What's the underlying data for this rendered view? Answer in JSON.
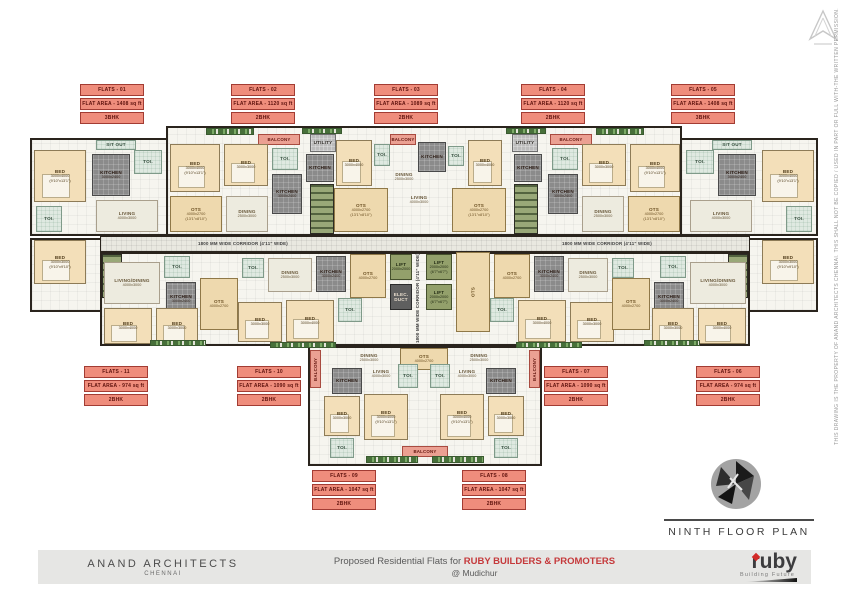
{
  "title_block": {
    "plan_title": "NINTH FLOOR PLAN",
    "firm_name": "ANAND ARCHITECTS",
    "firm_city": "CHENNAI",
    "project_text": "Proposed Residential Flats for",
    "client_name": "RUBY BUILDERS & PROMOTERS",
    "location_text": "@ Mudichur",
    "brand_name": "ruby",
    "brand_tagline": "Building Future"
  },
  "disclaimer": "THIS DRAWING IS THE PROPERTY OF ANAND ARCHITECTS CHENNAI. THIS SHALL NOT BE COPIED / USED IN PART OR FULL WITH-THE WRITTEN PERMISSION.",
  "colors": {
    "accent_red": "#c5393b",
    "flat_label_bg": "#ef8d7c",
    "flat_label_border": "#a23c33",
    "room_cream": "#f3dfb9",
    "ots_beige": "#eed9ae",
    "lift_green": "#93a06b",
    "kitchen_grey": "#8b8b8b"
  },
  "flat_labels": [
    {
      "name": "FLATS - 01",
      "area": "FLAT AREA - 1408 sq ft",
      "bhk": "3BHK",
      "x": 80,
      "y": 84
    },
    {
      "name": "FLATS - 02",
      "area": "FLAT AREA - 1120 sq ft",
      "bhk": "2BHK",
      "x": 231,
      "y": 84
    },
    {
      "name": "FLATS - 03",
      "area": "FLAT AREA - 1089 sq ft",
      "bhk": "2BHK",
      "x": 374,
      "y": 84
    },
    {
      "name": "FLATS - 04",
      "area": "FLAT AREA - 1120 sq ft",
      "bhk": "2BHK",
      "x": 521,
      "y": 84
    },
    {
      "name": "FLATS - 05",
      "area": "FLAT AREA - 1408 sq ft",
      "bhk": "3BHK",
      "x": 671,
      "y": 84
    },
    {
      "name": "FLATS - 11",
      "area": "FLAT AREA - 974 sq ft",
      "bhk": "2BHK",
      "x": 84,
      "y": 366
    },
    {
      "name": "FLATS - 10",
      "area": "FLAT AREA - 1090 sq ft",
      "bhk": "2BHK",
      "x": 237,
      "y": 366
    },
    {
      "name": "FLATS - 07",
      "area": "FLAT AREA - 1090 sq ft",
      "bhk": "2BHK",
      "x": 544,
      "y": 366
    },
    {
      "name": "FLATS - 06",
      "area": "FLAT AREA - 974 sq ft",
      "bhk": "2BHK",
      "x": 696,
      "y": 366
    },
    {
      "name": "FLATS - 09",
      "area": "FLAT AREA - 1047 sq ft",
      "bhk": "2BHK",
      "x": 312,
      "y": 470
    },
    {
      "name": "FLATS - 08",
      "area": "FLAT AREA - 1047 sq ft",
      "bhk": "2BHK",
      "x": 462,
      "y": 470
    }
  ],
  "plan": {
    "blocks": [
      {
        "x": 30,
        "y": 138,
        "w": 140,
        "h": 98
      },
      {
        "x": 166,
        "y": 126,
        "w": 516,
        "h": 110
      },
      {
        "x": 680,
        "y": 138,
        "w": 138,
        "h": 98
      },
      {
        "x": 30,
        "y": 238,
        "w": 72,
        "h": 74
      },
      {
        "x": 746,
        "y": 238,
        "w": 72,
        "h": 74
      },
      {
        "x": 100,
        "y": 252,
        "w": 650,
        "h": 94
      },
      {
        "x": 308,
        "y": 346,
        "w": 234,
        "h": 120
      },
      {
        "cls": "corridorblk",
        "x": 100,
        "y": 236,
        "w": 650,
        "h": 16
      }
    ],
    "rooms": [
      {
        "cls": "toi",
        "label": "SIT OUT",
        "x": 96,
        "y": 140,
        "w": 40,
        "h": 10
      },
      {
        "cls": "bed",
        "label": "BED",
        "dim": "3000x4000",
        "dim2": "(9'10\"x13'1\")",
        "x": 34,
        "y": 150,
        "w": 52,
        "h": 52
      },
      {
        "cls": "kitchen",
        "label": "KITCHEN",
        "dim": "3000x2400",
        "x": 92,
        "y": 154,
        "w": 38,
        "h": 42
      },
      {
        "cls": "toi",
        "label": "TOI.",
        "x": 134,
        "y": 150,
        "w": 28,
        "h": 24
      },
      {
        "cls": "hall",
        "label": "LIVING",
        "dim": "4000x3000",
        "x": 96,
        "y": 200,
        "w": 62,
        "h": 32
      },
      {
        "cls": "toi",
        "label": "TOI.",
        "x": 36,
        "y": 206,
        "w": 26,
        "h": 26
      },
      {
        "cls": "bed",
        "label": "BED",
        "dim": "3000x3000",
        "dim2": "(9'10\"x9'10\")",
        "x": 34,
        "y": 240,
        "w": 52,
        "h": 44
      },
      {
        "cls": "plants",
        "x": 206,
        "y": 128,
        "w": 48,
        "h": 7
      },
      {
        "cls": "balcony-label",
        "label": "BALCONY",
        "x": 258,
        "y": 134,
        "w": 42,
        "h": 11
      },
      {
        "cls": "bed",
        "label": "BED",
        "dim": "3000x4000",
        "dim2": "(9'10\"x13'1\")",
        "x": 170,
        "y": 144,
        "w": 50,
        "h": 48
      },
      {
        "cls": "bed",
        "label": "BED",
        "dim": "3000x3000",
        "x": 224,
        "y": 144,
        "w": 44,
        "h": 42
      },
      {
        "cls": "toi",
        "label": "TOI.",
        "x": 272,
        "y": 148,
        "w": 26,
        "h": 22
      },
      {
        "cls": "kitchen",
        "label": "KITCHEN",
        "dim": "3000x2400",
        "x": 272,
        "y": 174,
        "w": 30,
        "h": 40
      },
      {
        "cls": "ots",
        "label": "OTS",
        "dim": "4000x2700",
        "dim2": "(13'1\"x8'10\")",
        "x": 170,
        "y": 196,
        "w": 52,
        "h": 36
      },
      {
        "cls": "hall",
        "label": "DINING",
        "dim": "2500x3000",
        "x": 226,
        "y": 196,
        "w": 42,
        "h": 36
      },
      {
        "cls": "plants",
        "x": 302,
        "y": 128,
        "w": 40,
        "h": 6
      },
      {
        "cls": "plants",
        "x": 506,
        "y": 128,
        "w": 40,
        "h": 6
      },
      {
        "cls": "utility",
        "label": "UTILITY",
        "x": 310,
        "y": 134,
        "w": 26,
        "h": 18
      },
      {
        "cls": "kitchen",
        "label": "KITCHEN",
        "x": 306,
        "y": 154,
        "w": 28,
        "h": 28
      },
      {
        "cls": "stair",
        "x": 310,
        "y": 184,
        "w": 24,
        "h": 50
      },
      {
        "cls": "bed",
        "label": "BED",
        "dim": "3000x4000",
        "x": 336,
        "y": 140,
        "w": 36,
        "h": 46
      },
      {
        "cls": "toi",
        "label": "TOI.",
        "x": 374,
        "y": 144,
        "w": 16,
        "h": 22
      },
      {
        "cls": "balcony-label",
        "label": "BALCONY",
        "x": 390,
        "y": 134,
        "w": 26,
        "h": 11
      },
      {
        "cls": "kitchen",
        "label": "KITCHEN",
        "x": 418,
        "y": 142,
        "w": 28,
        "h": 30
      },
      {
        "cls": "toi",
        "label": "TOI.",
        "x": 448,
        "y": 146,
        "w": 16,
        "h": 20
      },
      {
        "cls": "bed",
        "label": "BED",
        "dim": "3000x4000",
        "x": 468,
        "y": 140,
        "w": 34,
        "h": 46
      },
      {
        "cls": "kitchen",
        "label": "KITCHEN",
        "x": 514,
        "y": 154,
        "w": 28,
        "h": 28
      },
      {
        "cls": "utility",
        "label": "UTILITY",
        "x": 512,
        "y": 134,
        "w": 26,
        "h": 18
      },
      {
        "cls": "stair",
        "x": 514,
        "y": 184,
        "w": 24,
        "h": 50
      },
      {
        "cls": "ots",
        "label": "OTS",
        "dim": "4000x2700",
        "dim2": "(13'1\"x8'10\")",
        "x": 334,
        "y": 188,
        "w": 54,
        "h": 44
      },
      {
        "cls": "ots",
        "label": "OTS",
        "dim": "4000x2700",
        "dim2": "(13'1\"x8'10\")",
        "x": 452,
        "y": 188,
        "w": 54,
        "h": 44
      },
      {
        "cls": "openlabel",
        "label": "DINING",
        "dim": "2500x3000",
        "x": 390,
        "y": 168,
        "w": 28,
        "h": 18
      },
      {
        "cls": "openlabel",
        "label": "LIVING",
        "dim": "4000x3000",
        "x": 404,
        "y": 192,
        "w": 30,
        "h": 16
      },
      {
        "cls": "plants",
        "x": 596,
        "y": 128,
        "w": 48,
        "h": 7
      },
      {
        "cls": "balcony-label",
        "label": "BALCONY",
        "x": 550,
        "y": 134,
        "w": 42,
        "h": 11
      },
      {
        "cls": "bed",
        "label": "BED",
        "dim": "3000x4000",
        "dim2": "(9'10\"x13'1\")",
        "x": 630,
        "y": 144,
        "w": 50,
        "h": 48
      },
      {
        "cls": "bed",
        "label": "BED",
        "dim": "3000x3000",
        "x": 582,
        "y": 144,
        "w": 44,
        "h": 42
      },
      {
        "cls": "toi",
        "label": "TOI.",
        "x": 552,
        "y": 148,
        "w": 26,
        "h": 22
      },
      {
        "cls": "kitchen",
        "label": "KITCHEN",
        "dim": "3000x2400",
        "x": 548,
        "y": 174,
        "w": 30,
        "h": 40
      },
      {
        "cls": "ots",
        "label": "OTS",
        "dim": "4000x2700",
        "dim2": "(13'1\"x8'10\")",
        "x": 628,
        "y": 196,
        "w": 52,
        "h": 36
      },
      {
        "cls": "hall",
        "label": "DINING",
        "dim": "2500x3000",
        "x": 582,
        "y": 196,
        "w": 42,
        "h": 36
      },
      {
        "cls": "toi",
        "label": "SIT OUT",
        "x": 712,
        "y": 140,
        "w": 40,
        "h": 10
      },
      {
        "cls": "bed",
        "label": "BED",
        "dim": "3000x4000",
        "dim2": "(9'10\"x13'1\")",
        "x": 762,
        "y": 150,
        "w": 52,
        "h": 52
      },
      {
        "cls": "kitchen",
        "label": "KITCHEN",
        "dim": "3000x2400",
        "x": 718,
        "y": 154,
        "w": 38,
        "h": 42
      },
      {
        "cls": "toi",
        "label": "TOI.",
        "x": 686,
        "y": 150,
        "w": 28,
        "h": 24
      },
      {
        "cls": "hall",
        "label": "LIVING",
        "dim": "4000x3000",
        "x": 690,
        "y": 200,
        "w": 62,
        "h": 32
      },
      {
        "cls": "toi",
        "label": "TOI.",
        "x": 786,
        "y": 206,
        "w": 26,
        "h": 26
      },
      {
        "cls": "bed",
        "label": "BED",
        "dim": "3000x3000",
        "dim2": "(9'10\"x9'10\")",
        "x": 762,
        "y": 240,
        "w": 52,
        "h": 44
      },
      {
        "cls": "corlabel",
        "label": "1800 MM WIDE CORRIDOR (4'11\" WIDE)",
        "x": 176,
        "y": 238,
        "w": 134,
        "h": 12
      },
      {
        "cls": "corlabel",
        "label": "1800 MM WIDE CORRIDOR (4'11\" WIDE)",
        "x": 540,
        "y": 238,
        "w": 134,
        "h": 12
      },
      {
        "cls": "corlabel vtext",
        "label": "1800 MM WIDE CORRIDOR (4'11\" WIDE)",
        "x": 412,
        "y": 252,
        "w": 11,
        "h": 92
      },
      {
        "cls": "lift",
        "label": "LIFT",
        "dim": "2000x2000",
        "x": 390,
        "y": 254,
        "w": 22,
        "h": 26
      },
      {
        "cls": "duct",
        "label": "ELEC. DUCT",
        "x": 390,
        "y": 284,
        "w": 22,
        "h": 26
      },
      {
        "cls": "lift",
        "label": "LIFT",
        "dim": "2000x2000",
        "dim2": "(6'7\"x6'7\")",
        "x": 426,
        "y": 254,
        "w": 26,
        "h": 26
      },
      {
        "cls": "lift",
        "label": "LIFT",
        "dim": "2000x2000",
        "dim2": "(6'7\"x6'7\")",
        "x": 426,
        "y": 284,
        "w": 26,
        "h": 26
      },
      {
        "cls": "ots vtext",
        "label": "OTS",
        "x": 456,
        "y": 252,
        "w": 34,
        "h": 80
      },
      {
        "cls": "stair",
        "x": 102,
        "y": 254,
        "w": 20,
        "h": 44
      },
      {
        "cls": "stair",
        "x": 728,
        "y": 254,
        "w": 20,
        "h": 44
      },
      {
        "cls": "hall",
        "label": "LIVING/DINING",
        "dim": "4000x3000",
        "x": 104,
        "y": 262,
        "w": 56,
        "h": 42
      },
      {
        "cls": "toi",
        "label": "TOI.",
        "x": 164,
        "y": 256,
        "w": 26,
        "h": 22
      },
      {
        "cls": "kitchen",
        "label": "KITCHEN",
        "dim": "3000x2400",
        "x": 166,
        "y": 282,
        "w": 30,
        "h": 34
      },
      {
        "cls": "ots",
        "label": "OTS",
        "dim": "4000x2700",
        "x": 200,
        "y": 278,
        "w": 38,
        "h": 52
      },
      {
        "cls": "bed",
        "label": "BED",
        "dim": "3000x4000",
        "x": 104,
        "y": 308,
        "w": 48,
        "h": 36
      },
      {
        "cls": "bed",
        "label": "BED",
        "dim": "3000x3000",
        "x": 156,
        "y": 308,
        "w": 42,
        "h": 36
      },
      {
        "cls": "plants",
        "x": 150,
        "y": 340,
        "w": 56,
        "h": 6
      },
      {
        "cls": "toi",
        "label": "TOI.",
        "x": 242,
        "y": 258,
        "w": 22,
        "h": 20
      },
      {
        "cls": "hall",
        "label": "DINING",
        "dim": "2500x3000",
        "x": 268,
        "y": 258,
        "w": 44,
        "h": 34
      },
      {
        "cls": "kitchen",
        "label": "KITCHEN",
        "dim": "3000x2400",
        "x": 316,
        "y": 256,
        "w": 30,
        "h": 36
      },
      {
        "cls": "ots",
        "label": "OTS",
        "dim": "4000x2700",
        "x": 350,
        "y": 254,
        "w": 36,
        "h": 44
      },
      {
        "cls": "bed",
        "label": "BED",
        "dim": "3000x4000",
        "x": 286,
        "y": 300,
        "w": 48,
        "h": 42
      },
      {
        "cls": "bed",
        "label": "BED",
        "dim": "3000x3000",
        "x": 238,
        "y": 302,
        "w": 44,
        "h": 40
      },
      {
        "cls": "toi",
        "label": "TOI.",
        "x": 338,
        "y": 298,
        "w": 24,
        "h": 24
      },
      {
        "cls": "plants",
        "x": 270,
        "y": 342,
        "w": 66,
        "h": 6
      },
      {
        "cls": "ots",
        "label": "OTS",
        "dim": "4000x2700",
        "x": 494,
        "y": 254,
        "w": 36,
        "h": 44
      },
      {
        "cls": "kitchen",
        "label": "KITCHEN",
        "dim": "3000x2400",
        "x": 534,
        "y": 256,
        "w": 30,
        "h": 36
      },
      {
        "cls": "hall",
        "label": "DINING",
        "dim": "2500x3000",
        "x": 568,
        "y": 258,
        "w": 40,
        "h": 34
      },
      {
        "cls": "toi",
        "label": "TOI.",
        "x": 612,
        "y": 258,
        "w": 22,
        "h": 20
      },
      {
        "cls": "bed",
        "label": "BED",
        "dim": "3000x4000",
        "x": 518,
        "y": 300,
        "w": 48,
        "h": 42
      },
      {
        "cls": "bed",
        "label": "BED",
        "dim": "3000x3000",
        "x": 570,
        "y": 302,
        "w": 44,
        "h": 40
      },
      {
        "cls": "toi",
        "label": "TOI.",
        "x": 490,
        "y": 298,
        "w": 24,
        "h": 24
      },
      {
        "cls": "plants",
        "x": 516,
        "y": 342,
        "w": 66,
        "h": 6
      },
      {
        "cls": "hall",
        "label": "LIVING/DINING",
        "dim": "4000x3000",
        "x": 690,
        "y": 262,
        "w": 56,
        "h": 42
      },
      {
        "cls": "toi",
        "label": "TOI.",
        "x": 660,
        "y": 256,
        "w": 26,
        "h": 22
      },
      {
        "cls": "kitchen",
        "label": "KITCHEN",
        "dim": "3000x2400",
        "x": 654,
        "y": 282,
        "w": 30,
        "h": 34
      },
      {
        "cls": "ots",
        "label": "OTS",
        "dim": "4000x2700",
        "x": 612,
        "y": 278,
        "w": 38,
        "h": 52
      },
      {
        "cls": "bed",
        "label": "BED",
        "dim": "3000x4000",
        "x": 698,
        "y": 308,
        "w": 48,
        "h": 36
      },
      {
        "cls": "bed",
        "label": "BED",
        "dim": "3000x3000",
        "x": 652,
        "y": 308,
        "w": 42,
        "h": 36
      },
      {
        "cls": "plants",
        "x": 644,
        "y": 340,
        "w": 56,
        "h": 6
      },
      {
        "cls": "balcony-label vtext",
        "label": "BALCONY",
        "x": 310,
        "y": 350,
        "w": 11,
        "h": 38
      },
      {
        "cls": "balcony-label vtext",
        "label": "BALCONY",
        "x": 529,
        "y": 350,
        "w": 11,
        "h": 38
      },
      {
        "cls": "openlabel",
        "label": "DINING",
        "dim": "2500x3000",
        "x": 348,
        "y": 350,
        "w": 42,
        "h": 16
      },
      {
        "cls": "ots",
        "label": "OTS",
        "dim": "4000x2700",
        "x": 400,
        "y": 348,
        "w": 48,
        "h": 22
      },
      {
        "cls": "openlabel",
        "label": "DINING",
        "dim": "2500x3000",
        "x": 458,
        "y": 350,
        "w": 42,
        "h": 16
      },
      {
        "cls": "kitchen",
        "label": "KITCHEN",
        "x": 332,
        "y": 368,
        "w": 30,
        "h": 26
      },
      {
        "cls": "openlabel",
        "label": "LIVING",
        "dim": "4000x3000",
        "x": 366,
        "y": 366,
        "w": 30,
        "h": 16
      },
      {
        "cls": "toi",
        "label": "TOI.",
        "x": 398,
        "y": 364,
        "w": 20,
        "h": 24
      },
      {
        "cls": "toi",
        "label": "TOI.",
        "x": 430,
        "y": 364,
        "w": 20,
        "h": 24
      },
      {
        "cls": "kitchen",
        "label": "KITCHEN",
        "x": 486,
        "y": 368,
        "w": 30,
        "h": 26
      },
      {
        "cls": "openlabel",
        "label": "LIVING",
        "dim": "4000x3000",
        "x": 452,
        "y": 366,
        "w": 30,
        "h": 16
      },
      {
        "cls": "bed",
        "label": "BED",
        "dim": "3000x3000",
        "x": 324,
        "y": 396,
        "w": 36,
        "h": 40
      },
      {
        "cls": "bed",
        "label": "BED",
        "dim": "3000x4000",
        "dim2": "(9'10\"x13'1\")",
        "x": 364,
        "y": 394,
        "w": 44,
        "h": 46
      },
      {
        "cls": "bed",
        "label": "BED",
        "dim": "3000x4000",
        "dim2": "(9'10\"x13'1\")",
        "x": 440,
        "y": 394,
        "w": 44,
        "h": 46
      },
      {
        "cls": "bed",
        "label": "BED",
        "dim": "3000x3000",
        "x": 488,
        "y": 396,
        "w": 36,
        "h": 40
      },
      {
        "cls": "toi",
        "label": "TOI.",
        "x": 330,
        "y": 438,
        "w": 24,
        "h": 20
      },
      {
        "cls": "toi",
        "label": "TOI.",
        "x": 494,
        "y": 438,
        "w": 24,
        "h": 20
      },
      {
        "cls": "balcony-label",
        "label": "BALCONY",
        "x": 402,
        "y": 446,
        "w": 46,
        "h": 11
      },
      {
        "cls": "plants",
        "x": 366,
        "y": 456,
        "w": 52,
        "h": 7
      },
      {
        "cls": "plants",
        "x": 432,
        "y": 456,
        "w": 52,
        "h": 7
      }
    ]
  }
}
